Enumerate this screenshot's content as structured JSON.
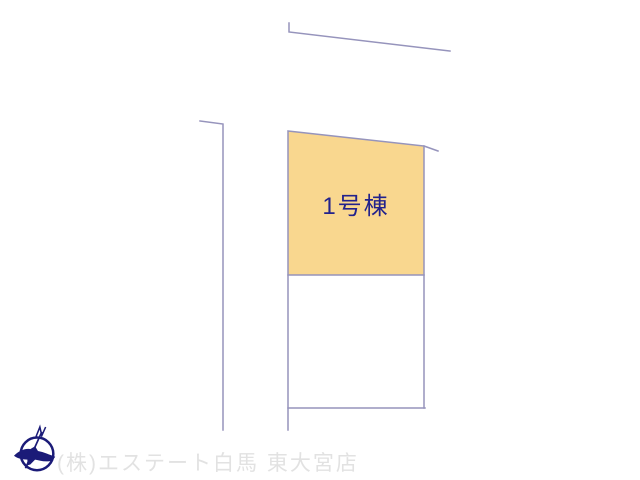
{
  "colors": {
    "background": "#FFFFFF",
    "parcel_fill": "#F9D78F",
    "boundary_line": "#9694BC",
    "label_text": "#22228C",
    "watermark_text": "#E2E2E2",
    "compass": "#1B1B78"
  },
  "diagram": {
    "building_label": "1号棟",
    "boundaries": {
      "road_top": "289,23 289,32 450,51",
      "road_left": "200,121 223,124 223,430",
      "building_plot": "288,131 424,146 424,275 288,275",
      "plot_corner_extension": "424,146 438,151",
      "lower_parcel_right": "424,275 424,408",
      "lower_parcel_bottom": "288,408 425,408",
      "parcel_left_edge": "288,275 288,430"
    }
  },
  "footer": {
    "company_watermark": "(株)エステート白馬 東大宮店",
    "compass_letter": "N"
  }
}
